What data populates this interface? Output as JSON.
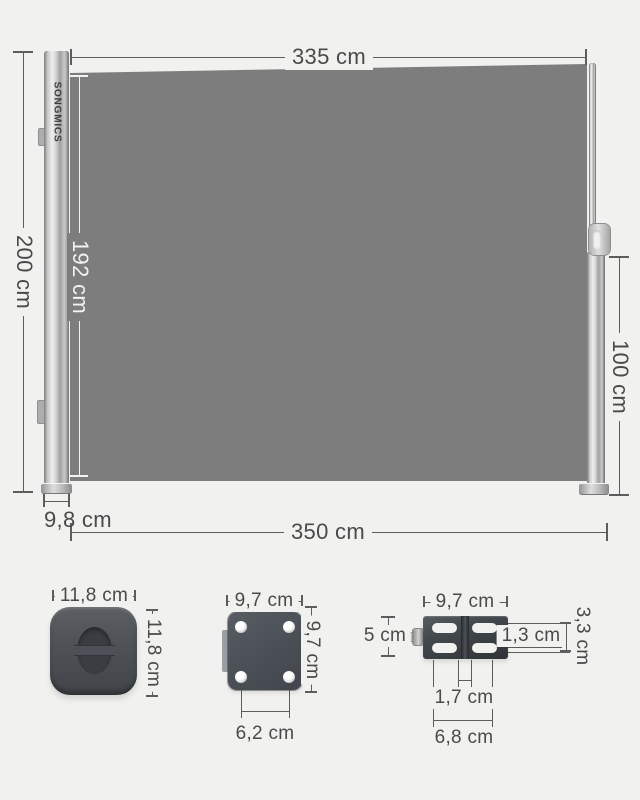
{
  "brand_logo": "SONGMICS",
  "main": {
    "top_width": "335 cm",
    "total_height": "200 cm",
    "fabric_height": "192 cm",
    "pole_height": "100 cm",
    "cassette_depth": "9,8 cm",
    "total_width": "350 cm"
  },
  "cap_detail": {
    "width": "11,8 cm",
    "height": "11,8 cm"
  },
  "plate_detail": {
    "width": "9,7 cm",
    "height": "9,7 cm",
    "hole_spacing": "6,2 cm"
  },
  "bracket_detail": {
    "width": "9,7 cm",
    "height": "5 cm",
    "slot_height": "1,3 cm",
    "slot_span": "3,3 cm",
    "slot_gap": "1,7 cm",
    "outer_width": "6,8 cm"
  },
  "colors": {
    "background": "#f1f1ef",
    "fabric": "#7d7d7d",
    "dark_part": "#4a4e53",
    "dimension_line": "#5d5d5d",
    "dimension_text": "#4a4a4a"
  }
}
